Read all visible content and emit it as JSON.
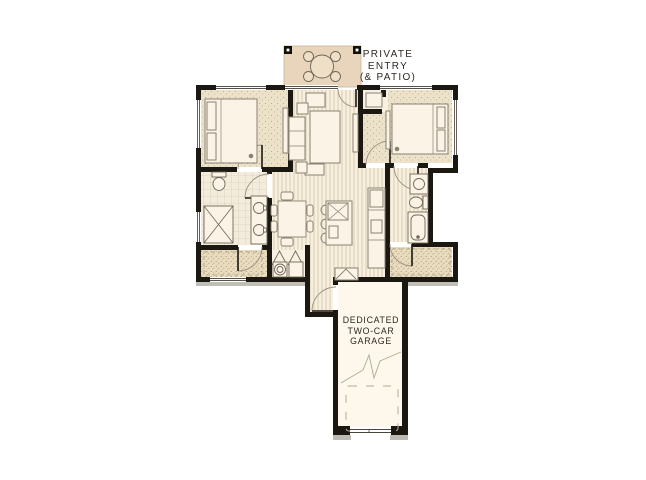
{
  "canvas": {
    "width": 646,
    "height": 480,
    "background": "#ffffff"
  },
  "labels": {
    "private_entry": "PRIVATE\nENTRY\n(& PATIO)",
    "garage": "DEDICATED\nTWO-CAR\nGARAGE"
  },
  "colors": {
    "wall": "#1b1711",
    "floor_cream": "#f8f1e2",
    "patio_tan": "#e9d5bb",
    "bedroom_carpet": "#ece1c9",
    "closet_carpet": "#e9dcbf",
    "garage_floor": "#fdf7ec",
    "furniture_line": "#8a8170",
    "door_swing_line": "#9a9180",
    "label_text": "#2e2a22",
    "shadow_gray": "#a09a90"
  }
}
